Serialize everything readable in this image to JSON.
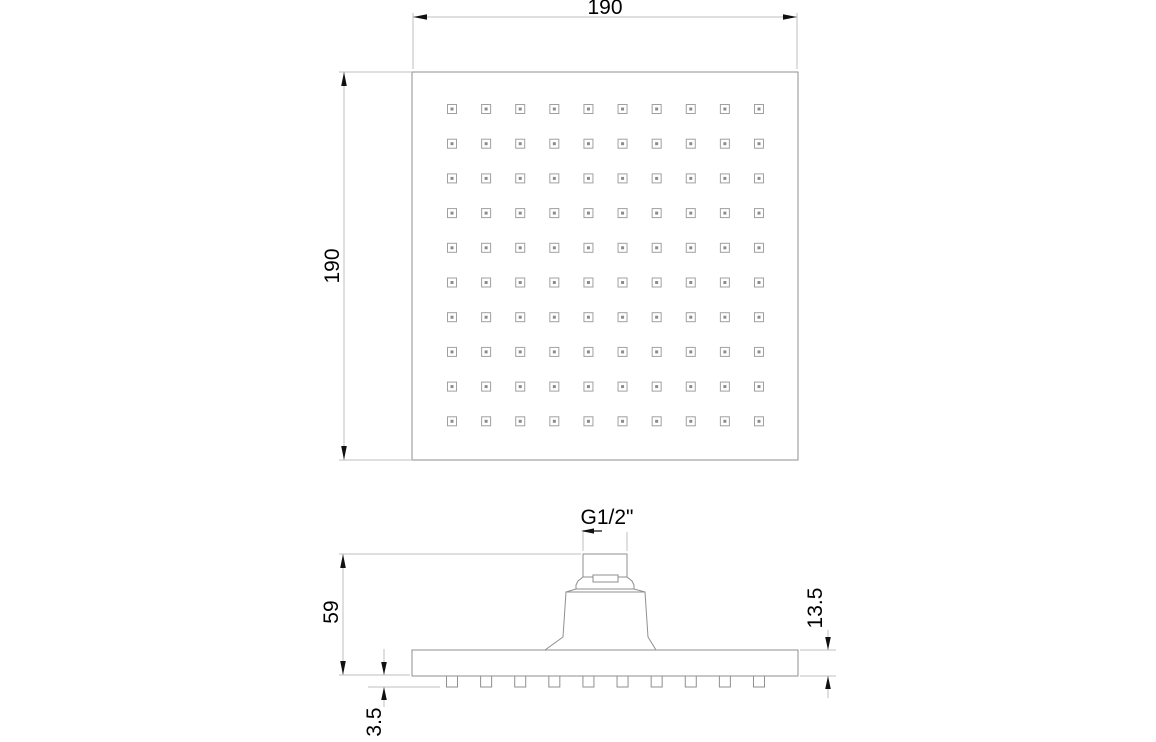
{
  "page": {
    "background": "#ffffff",
    "description": "Technical dimension drawing of a square overhead shower head: top view (spray face) and side elevation"
  },
  "labels": {
    "top_width": "190",
    "side_height": "190",
    "head_height": "59",
    "plate_thickness": "13.5",
    "nozzle_protrusion": "3.5",
    "thread_size": "G1/2\""
  },
  "nozzle_grid": {
    "rows": 10,
    "cols": 10
  },
  "colors": {
    "object_line": "#8f8f8f",
    "nozzle_line": "#a0a0a0",
    "nozzle_dot": "#8c8c8c",
    "dimension_line": "#bfbfbf",
    "arrow": "#111111",
    "text": "#000000"
  }
}
